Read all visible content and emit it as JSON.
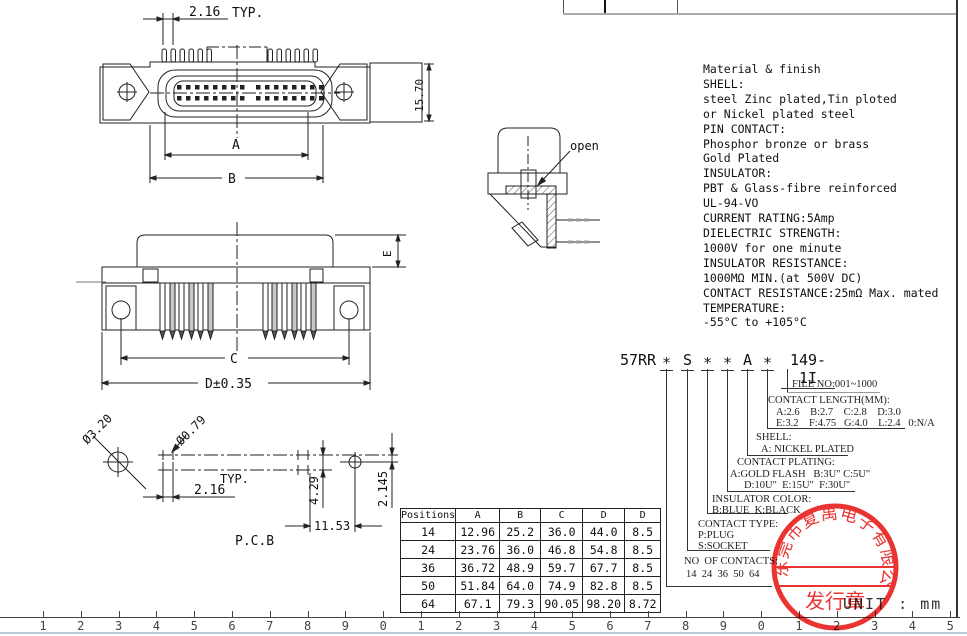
{
  "unit": {
    "label": "UNIT : mm"
  },
  "material_finish": {
    "lines": [
      "Material & finish",
      "SHELL:",
      "steel Zinc plated,Tin ploted",
      "or Nickel plated steel",
      "PIN CONTACT:",
      "Phosphor bronze or brass",
      "Gold Plated",
      "INSULATOR:",
      "PBT & Glass-fibre reinforced",
      "UL-94-VO",
      "CURRENT RATING:5Amp",
      "DIELECTRIC STRENGTH:",
      "1000V for one minute",
      "INSULATOR RESISTANCE:",
      "1000MΩ MIN.(at 500V DC)",
      "CONTACT RESISTANCE:25mΩ Max. mated",
      "TEMPERATURE:",
      "-55°C to +105°C"
    ]
  },
  "part_number": {
    "segments": [
      "57RR",
      "∗",
      "S",
      "∗",
      "∗",
      "A",
      "∗",
      "149-1I"
    ],
    "callouts": [
      {
        "title": "FILE NO:001~1000",
        "line1": "",
        "line2": ""
      },
      {
        "title": "CONTACT LENGTH(MM):",
        "line1": "A:2.6    B:2.7    C:2.8    D:3.0",
        "line2": "E:3.2    F:4.75   G:4.0    L:2.4   0:N/A"
      },
      {
        "title": "SHELL:",
        "line1": "A: NICKEL PLATED",
        "line2": ""
      },
      {
        "title": "CONTACT PLATING:",
        "line1": "A:GOLD FLASH   B:3U\" C:5U\"",
        "line2": "D:10U\"  E:15U\"  F:30U\""
      },
      {
        "title": "INSULATOR COLOR:",
        "line1": "B:BLUE  K:BLACK",
        "line2": ""
      },
      {
        "title": "CONTACT TYPE:",
        "line1": "P:PLUG",
        "line2": "S:SOCKET"
      },
      {
        "title": "NO  OF CONTACTS:",
        "line1": "14  24  36  50  64",
        "line2": ""
      }
    ]
  },
  "dimensions_table": {
    "headers": [
      "Positions",
      "A",
      "B",
      "C",
      "D",
      "D"
    ],
    "rows": [
      [
        "14",
        "12.96",
        "25.2",
        "36.0",
        "44.0",
        "8.5"
      ],
      [
        "24",
        "23.76",
        "36.0",
        "46.8",
        "54.8",
        "8.5"
      ],
      [
        "36",
        "36.72",
        "48.9",
        "59.7",
        "67.7",
        "8.5"
      ],
      [
        "50",
        "51.84",
        "64.0",
        "74.9",
        "82.8",
        "8.5"
      ],
      [
        "64",
        "67.1",
        "79.3",
        "90.05",
        "98.20",
        "8.72"
      ]
    ]
  },
  "drawing_labels": {
    "front_view": {
      "pitch": "2.16",
      "typ": "TYP.",
      "height": "15.70",
      "dim_a": "A",
      "dim_b": "B"
    },
    "side_view": {
      "dim_c": "C",
      "dim_d": "D±0.35",
      "dim_e": "E"
    },
    "section_view": {
      "open": "open"
    },
    "pcb_view": {
      "title": "P.C.B",
      "hole_large": "Ø3.20",
      "hole_small": "Ø0.79",
      "pitch": "2.16",
      "typ": "TYP.",
      "row_gap": "4.29",
      "half_gap": "2.145",
      "end_dist": "11.53"
    }
  },
  "stamp": {
    "company": "东莞市复禹电子有限公司",
    "label": "发行章",
    "color": "#e8221f"
  },
  "ruler": {
    "numbers": [
      "1",
      "2",
      "3",
      "4",
      "5",
      "6",
      "7",
      "8",
      "9",
      "0",
      "1",
      "2",
      "3",
      "4",
      "5",
      "6",
      "7",
      "8",
      "9",
      "0",
      "1",
      "2",
      "3",
      "4",
      "5"
    ]
  }
}
